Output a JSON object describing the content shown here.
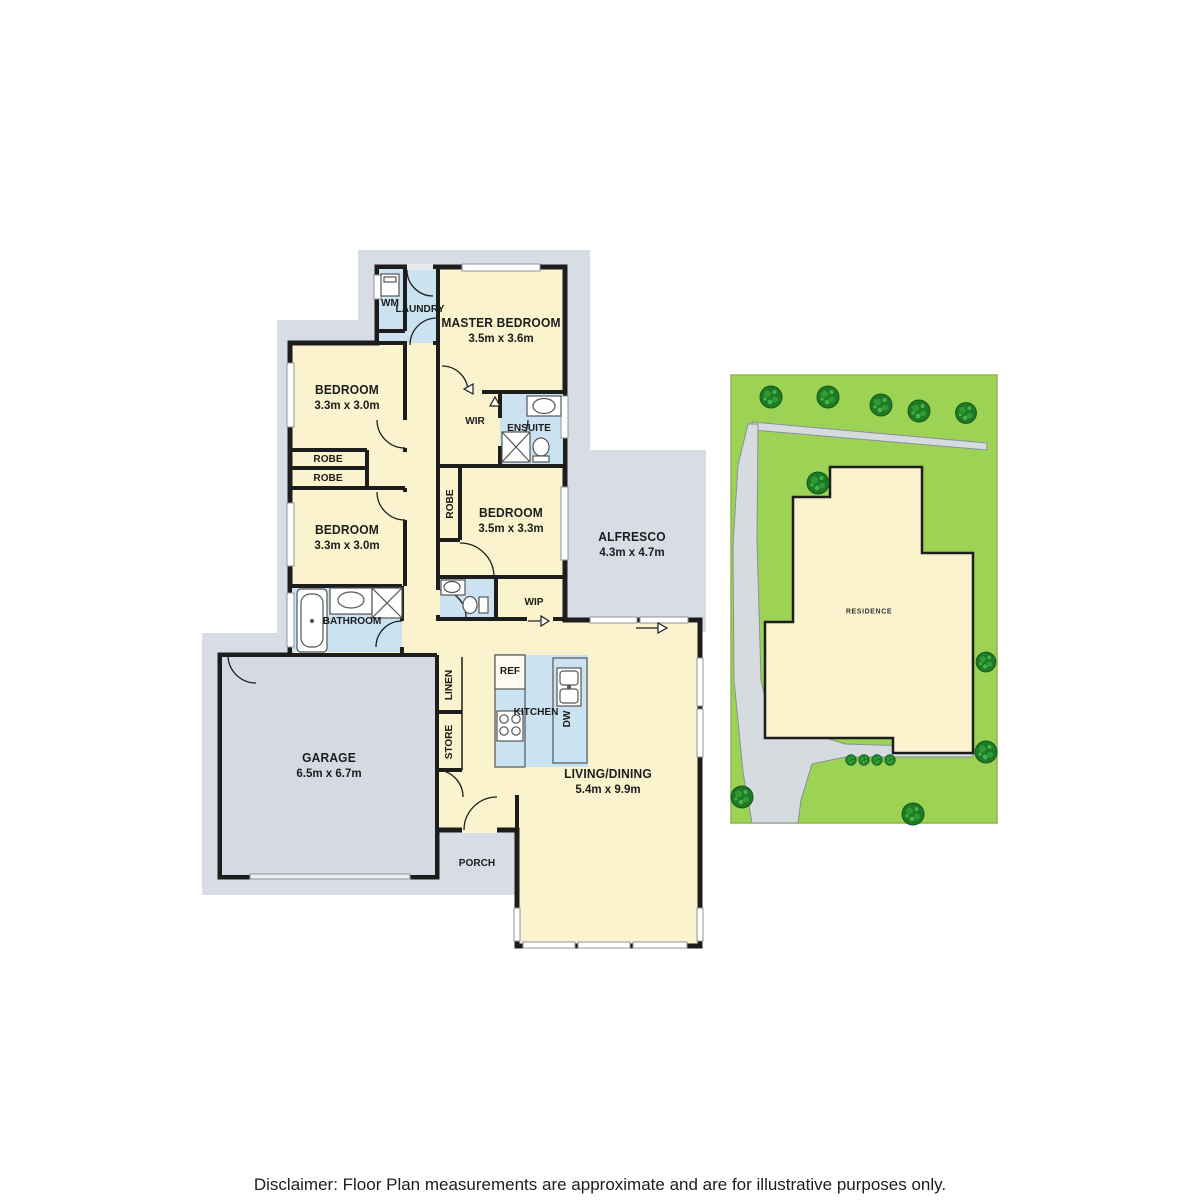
{
  "floorplan": {
    "rooms": {
      "master": {
        "name": "MASTER BEDROOM",
        "dims": "3.5m x 3.6m"
      },
      "bedroom1": {
        "name": "BEDROOM",
        "dims": "3.3m x 3.0m"
      },
      "bedroom2": {
        "name": "BEDROOM",
        "dims": "3.3m x 3.0m"
      },
      "bedroom3": {
        "name": "BEDROOM",
        "dims": "3.5m x 3.3m"
      },
      "alfresco": {
        "name": "ALFRESCO",
        "dims": "4.3m x 4.7m"
      },
      "garage": {
        "name": "GARAGE",
        "dims": "6.5m x 6.7m"
      },
      "living": {
        "name": "LIVING/DINING",
        "dims": "5.4m x 9.9m"
      },
      "laundry": "LAUNDRY",
      "wm": "WM",
      "wir": "WIR",
      "ensuite": "ENSUITE",
      "robe": "ROBE",
      "bathroom": "BATHROOM",
      "wip": "WIP",
      "linen": "LINEN",
      "store": "STORE",
      "ref": "REF",
      "kitchen": "KITCHEN",
      "dw": "DW",
      "porch": "PORCH"
    },
    "site": {
      "residence": "RESIDENCE"
    },
    "disclaimer": "Disclaimer: Floor Plan measurements are approximate and are for illustrative purposes only.",
    "colors": {
      "room_fill": "#faf3cd",
      "wet_area_fill": "#cbe3f1",
      "outline_gray": "#d8dde5",
      "wall": "#1d1d1d",
      "site_grass": "#9cd355",
      "tree": "#1e7a24",
      "path_gray": "#d6dbe0"
    }
  }
}
